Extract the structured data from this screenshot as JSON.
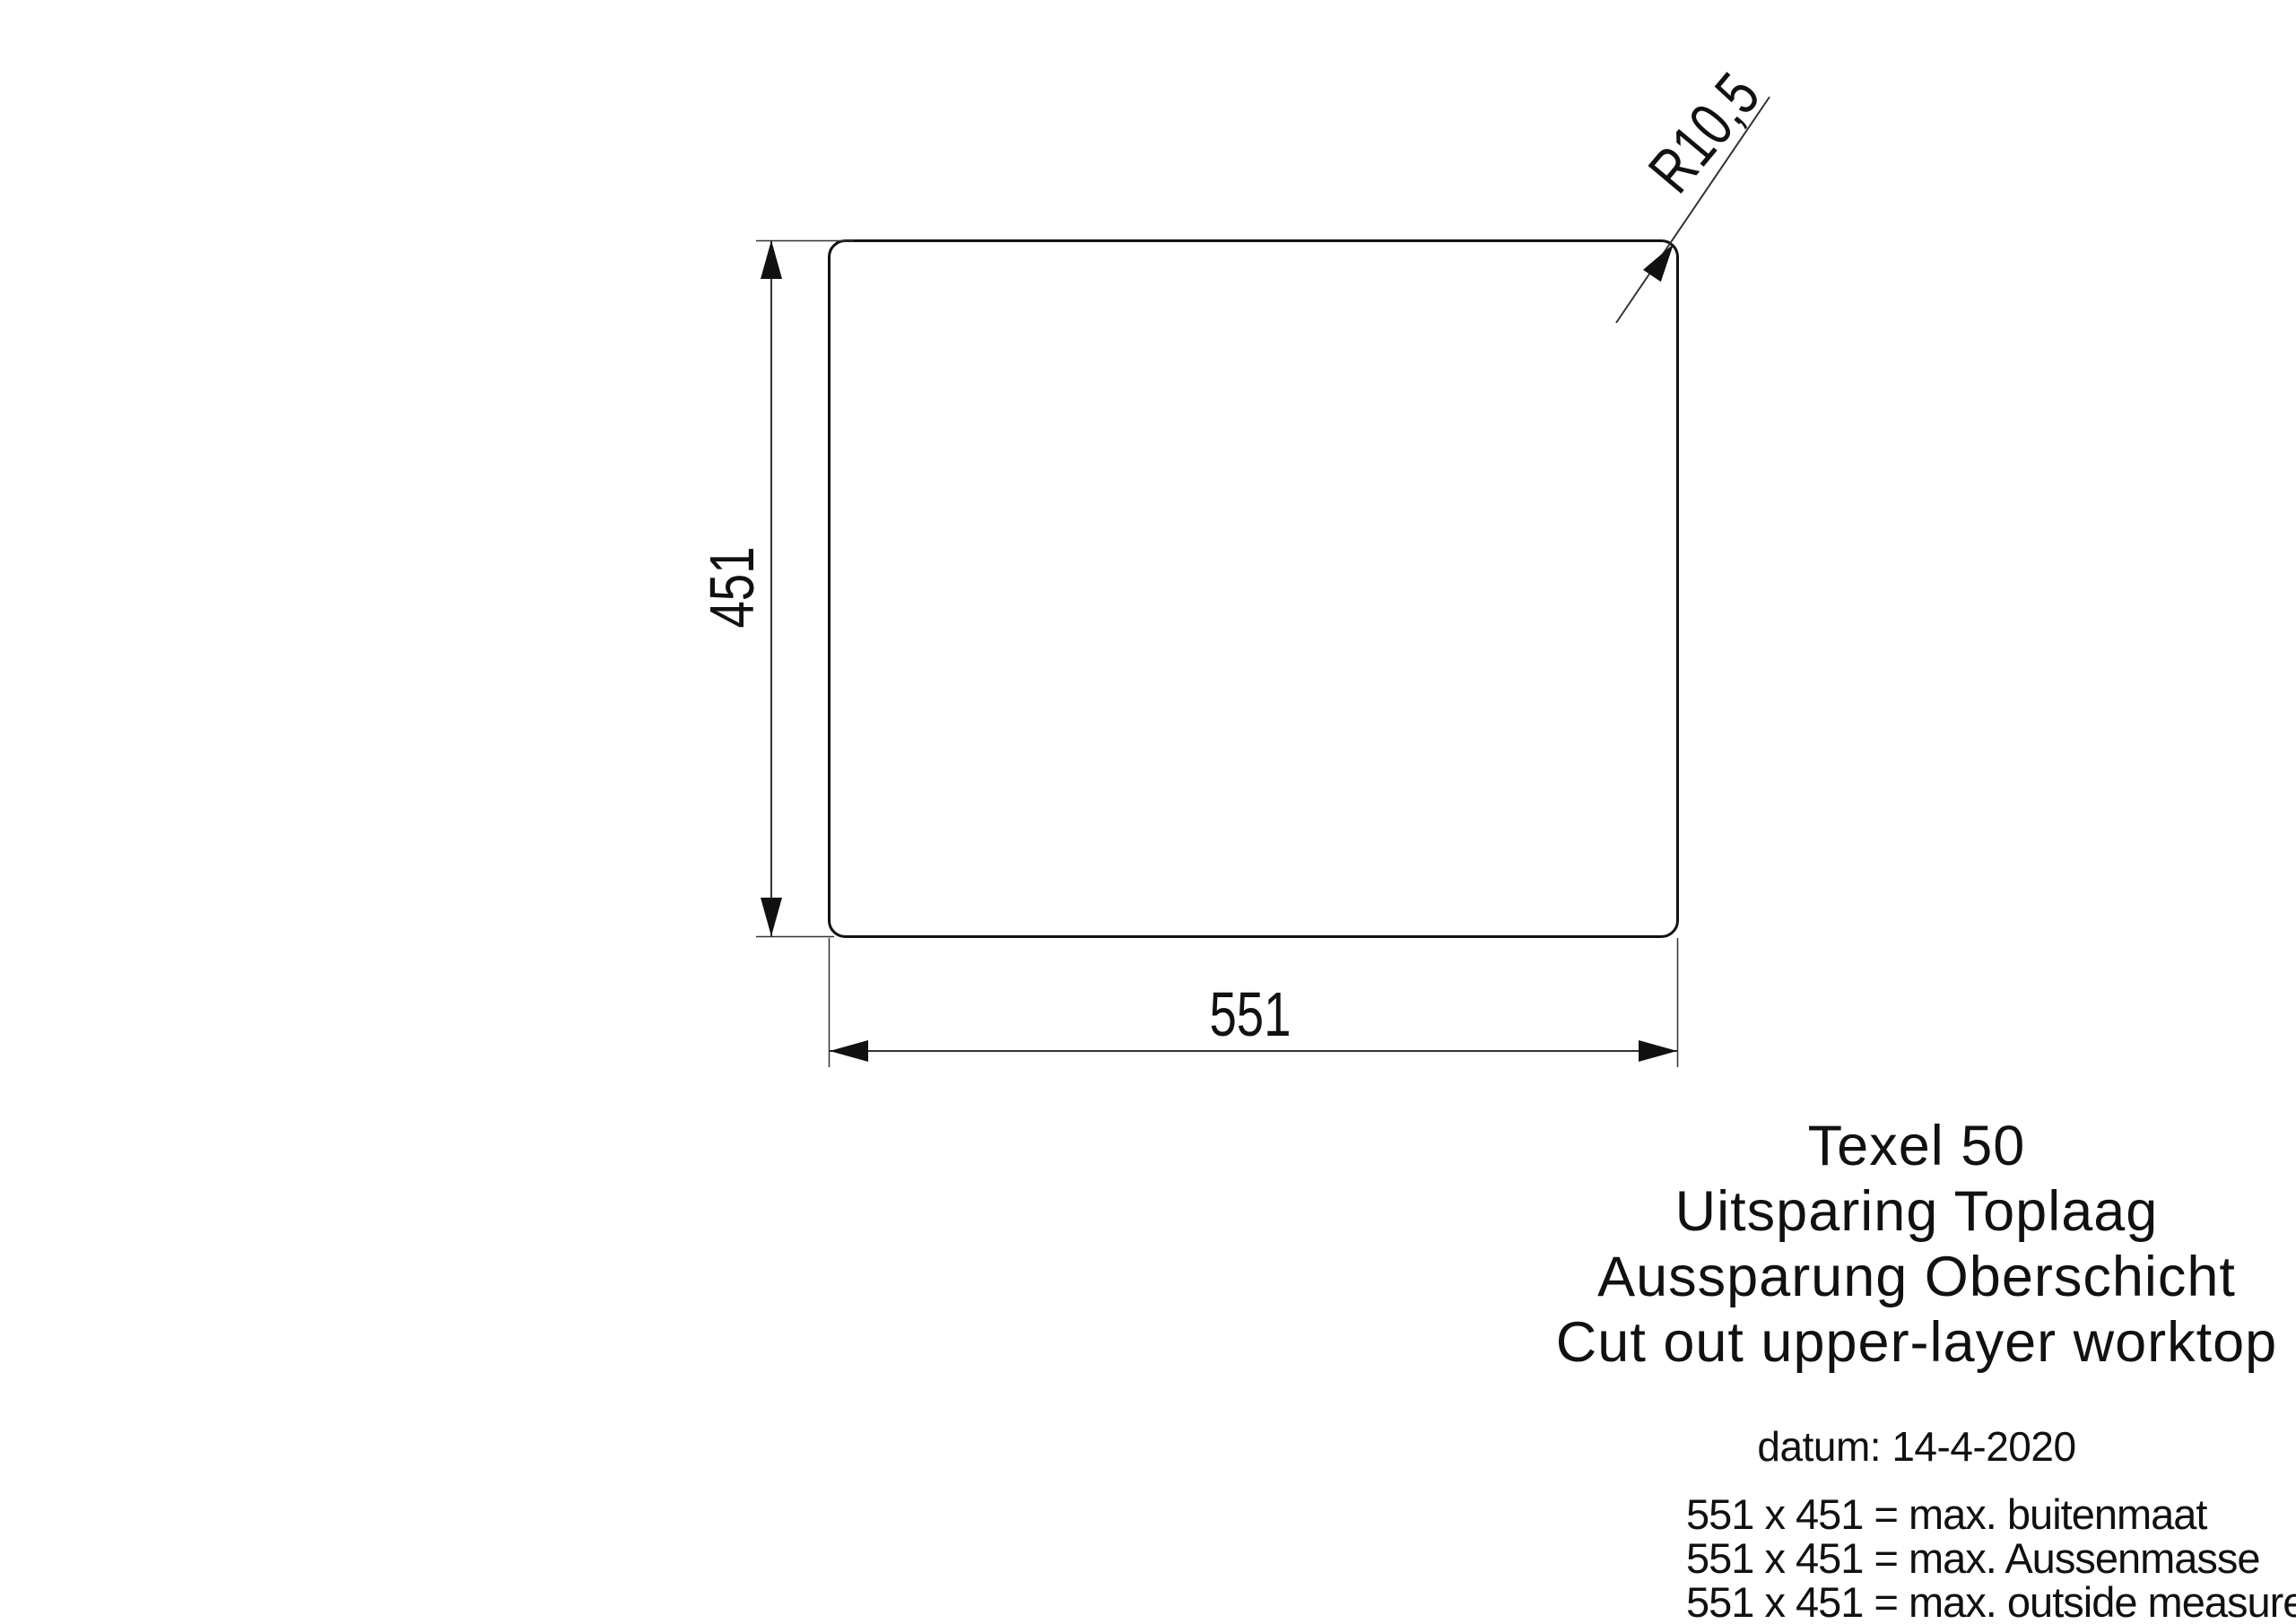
{
  "drawing": {
    "width_dim": "551",
    "height_dim": "451",
    "corner_radius": "R10,5"
  },
  "titles": {
    "product": "Texel 50",
    "line_nl": "Uitsparing Toplaag",
    "line_de": "Aussparung Oberschicht",
    "line_en": "Cut out upper-layer worktop"
  },
  "date": "datum: 14-4-2020",
  "notes": [
    "551 x 451 = max. buitenmaat",
    "551 x 451 = max. Aussenmasse",
    "551 x 451 = max. outside measure"
  ],
  "colors": {
    "outline": "#111111",
    "thin_line": "#333333",
    "text": "#111111",
    "background": "#ffffff"
  }
}
